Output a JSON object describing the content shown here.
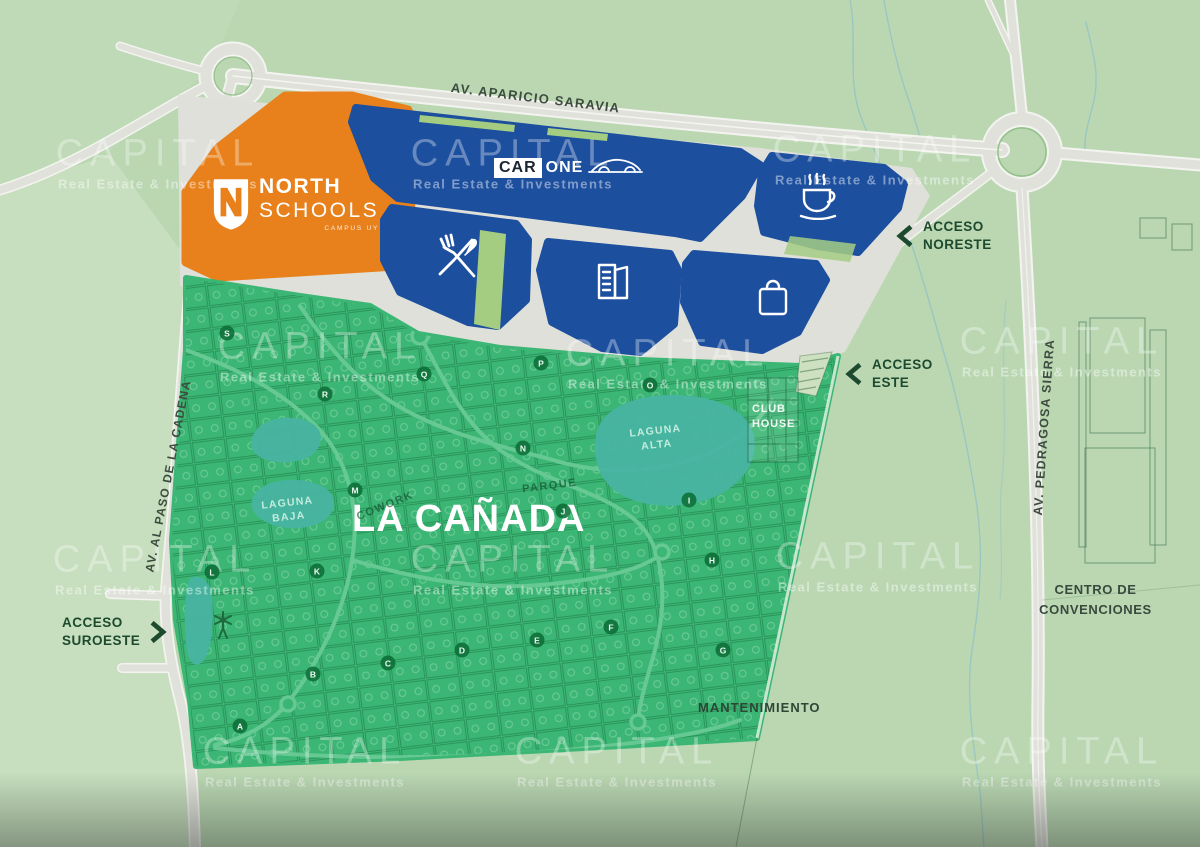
{
  "watermark": {
    "title": "CAPITAL",
    "subtitle": "Real Estate & Investments"
  },
  "roads": {
    "aparicio_saravia": "AV. APARICIO SARAVIA",
    "paso_de_la_cadena": "AV. AL PASO DE LA CADENA",
    "pedragosa_sierra": "AV. PEDRAGOSA SIERRA"
  },
  "accesses": {
    "noreste": {
      "line1": "ACCESO",
      "line2": "NORESTE"
    },
    "este": {
      "line1": "ACCESO",
      "line2": "ESTE"
    },
    "suroeste": {
      "line1": "ACCESO",
      "line2": "SUROESTE"
    }
  },
  "development": {
    "name": "LA CAÑADA",
    "club_house": {
      "line1": "CLUB",
      "line2": "HOUSE"
    },
    "laguna_alta": {
      "line1": "LAGUNA",
      "line2": "ALTA"
    },
    "laguna_baja": {
      "line1": "LAGUNA",
      "line2": "BAJA"
    },
    "parque": "PARQUE",
    "cowork": "COWORK",
    "mantenimiento": "MANTENIMIENTO",
    "lot_markers": [
      {
        "letter": "A",
        "x": 240,
        "y": 726
      },
      {
        "letter": "B",
        "x": 313,
        "y": 674
      },
      {
        "letter": "C",
        "x": 388,
        "y": 663
      },
      {
        "letter": "D",
        "x": 462,
        "y": 650
      },
      {
        "letter": "E",
        "x": 537,
        "y": 640
      },
      {
        "letter": "F",
        "x": 611,
        "y": 627
      },
      {
        "letter": "G",
        "x": 723,
        "y": 650
      },
      {
        "letter": "H",
        "x": 712,
        "y": 560
      },
      {
        "letter": "I",
        "x": 689,
        "y": 500
      },
      {
        "letter": "J",
        "x": 563,
        "y": 511
      },
      {
        "letter": "K",
        "x": 317,
        "y": 571
      },
      {
        "letter": "L",
        "x": 212,
        "y": 572
      },
      {
        "letter": "M",
        "x": 355,
        "y": 490
      },
      {
        "letter": "N",
        "x": 523,
        "y": 448
      },
      {
        "letter": "O",
        "x": 650,
        "y": 385
      },
      {
        "letter": "P",
        "x": 541,
        "y": 363
      },
      {
        "letter": "Q",
        "x": 424,
        "y": 374
      },
      {
        "letter": "R",
        "x": 325,
        "y": 394
      },
      {
        "letter": "S",
        "x": 227,
        "y": 333
      }
    ]
  },
  "pois": {
    "centro_convenciones": {
      "line1": "CENTRO DE",
      "line2": "CONVENCIONES"
    }
  },
  "logos": {
    "north_schools": {
      "line1": "NORTH",
      "line2": "SCHOOLS",
      "tagline": "CAMPUS UY"
    },
    "car_one": {
      "part1": "CAR",
      "part2": "ONE"
    }
  },
  "icons": {
    "cafe": "coffee-icon",
    "restaurant": "restaurant-icon",
    "offices": "office-building-icon",
    "shopping": "shopping-bag-icon",
    "car_dealer": "car-icon",
    "school": "shield-icon",
    "windmill": "windmill-icon"
  },
  "colors": {
    "commercial_blue": "#1d4f9f",
    "school_orange": "#e8811c",
    "development_green": "#3cb674",
    "lagoon_teal": "#48b4a2",
    "background_sage": "#bad7b2",
    "road_gray": "#e0e1da",
    "label_dark_green": "#1d4a2e",
    "marker_green": "#117a3f"
  }
}
